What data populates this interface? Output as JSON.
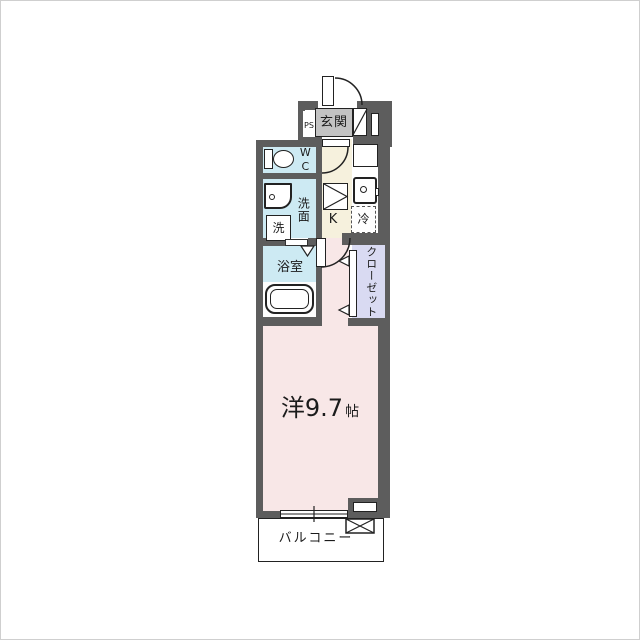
{
  "plan_type": "apartment-floor-plan",
  "colors": {
    "wall": "#5d5d5d",
    "wet_rooms": "#cdeaf3",
    "hallway_kitchen": "#f6f1dd",
    "closet": "#d9daf2",
    "main_room": "#f8e7e7",
    "entrance_box": "#c3c3c3",
    "line": "#222222"
  },
  "rooms": {
    "entrance": {
      "label": "玄関"
    },
    "pipe_space": {
      "label": "PS"
    },
    "wc": {
      "label": "WC"
    },
    "washroom": {
      "label": "洗面"
    },
    "laundry": {
      "label": "洗"
    },
    "kitchen": {
      "label": "K"
    },
    "refrigerator": {
      "label": "冷"
    },
    "bathroom": {
      "label": "浴室"
    },
    "closet": {
      "label": "クローゼット"
    },
    "western_room": {
      "label": "洋9.7",
      "unit": "帖"
    },
    "balcony": {
      "label": "バルコニー"
    }
  }
}
